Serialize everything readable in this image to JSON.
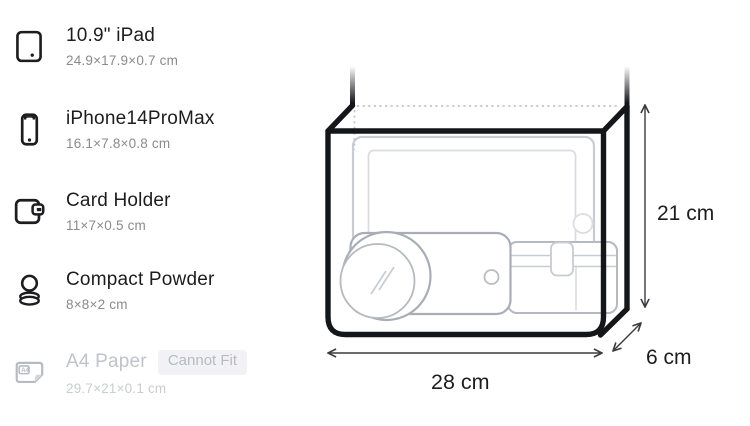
{
  "items": [
    {
      "name": "10.9\" iPad",
      "dims": "24.9×17.9×0.7 cm",
      "icon": "tablet-icon",
      "fits": true
    },
    {
      "name": "iPhone14ProMax",
      "dims": "16.1×7.8×0.8 cm",
      "icon": "phone-icon",
      "fits": true
    },
    {
      "name": "Card Holder",
      "dims": "11×7×0.5 cm",
      "icon": "wallet-icon",
      "fits": true
    },
    {
      "name": "Compact Powder",
      "dims": "8×8×2 cm",
      "icon": "compact-powder-icon",
      "fits": true
    },
    {
      "name": "A4 Paper",
      "dims": "29.7×21×0.1 cm",
      "icon": "a4-paper-icon",
      "fits": false,
      "badge": "Cannot Fit",
      "icon_text": "A4"
    }
  ],
  "diagram": {
    "width_label": "28 cm",
    "height_label": "21 cm",
    "depth_label": "6 cm",
    "contents": [
      "ipad-outline",
      "iphone-outline",
      "card-holder-outline",
      "compact-powder-outline"
    ]
  },
  "colors": {
    "ink": "#1d1d1f",
    "bag_outline": "#15161a",
    "muted_text": "#8a8a8f",
    "disabled_text": "#c0c3c9",
    "badge_bg": "#f2f2f6",
    "item_outline_light": "#c9ccd3",
    "item_outline_mid": "#a9aeb6",
    "dimension_line": "#3a3b40"
  }
}
